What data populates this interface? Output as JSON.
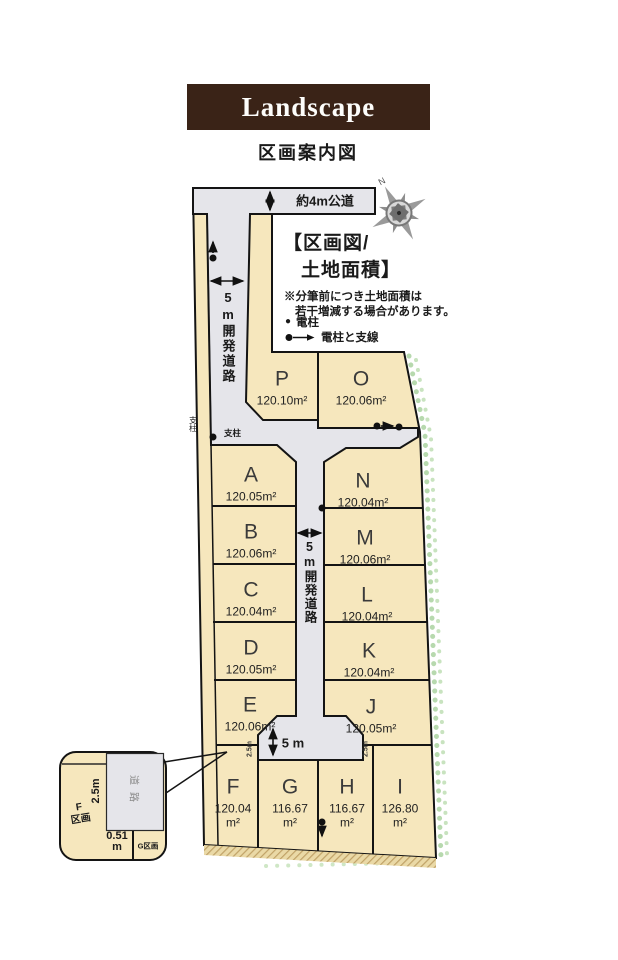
{
  "header": {
    "brand": "Landscape",
    "title": "区画案内図"
  },
  "legend": {
    "heading_line1": "【区画図/",
    "heading_line2": "土地面積】",
    "note_line1": "※分筆前につき土地面積は",
    "note_line2": "若干増減する場合があります。",
    "pole_dot": "●",
    "pole_label": "電柱",
    "guywire_label": "電柱と支線"
  },
  "compass": {
    "north_label": "N"
  },
  "dimensions": {
    "public_road": "約4m公道",
    "dev_road_vertical": "5m開発道路",
    "turnaround_width": "5 m",
    "setback": "2.5m",
    "support_pole": "支柱"
  },
  "inset": {
    "plot_f_letter": "F",
    "plot_f_label": "区画",
    "road_label": "道路",
    "width_label": "2.5m",
    "offset_value": "0.51",
    "offset_unit": "m",
    "plot_g_label": "G区画"
  },
  "site": {
    "area_unit": "m²",
    "plots": [
      {
        "id": "A",
        "area": "120.05"
      },
      {
        "id": "B",
        "area": "120.06"
      },
      {
        "id": "C",
        "area": "120.04"
      },
      {
        "id": "D",
        "area": "120.05"
      },
      {
        "id": "E",
        "area": "120.06"
      },
      {
        "id": "F",
        "area": "120.04"
      },
      {
        "id": "G",
        "area": "116.67"
      },
      {
        "id": "H",
        "area": "116.67"
      },
      {
        "id": "I",
        "area": "126.80"
      },
      {
        "id": "J",
        "area": "120.05"
      },
      {
        "id": "K",
        "area": "120.04"
      },
      {
        "id": "L",
        "area": "120.04"
      },
      {
        "id": "M",
        "area": "120.06"
      },
      {
        "id": "N",
        "area": "120.04"
      },
      {
        "id": "O",
        "area": "120.06"
      },
      {
        "id": "P",
        "area": "120.10"
      }
    ]
  },
  "colors": {
    "brand_brown": "#3a2317",
    "plot_cream": "#f6e7bd",
    "road_gray": "#e5e5ea",
    "hedge_green": "#b7d9ae"
  }
}
